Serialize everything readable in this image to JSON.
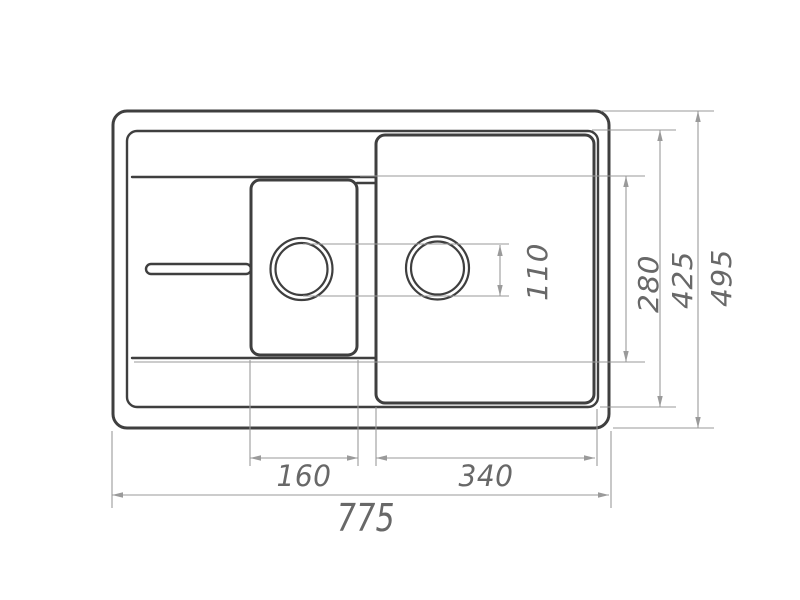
{
  "colors": {
    "background": "#ffffff",
    "outline": "#3f3f3f",
    "dimension_line": "#9a9a9a",
    "dimension_text": "#686868"
  },
  "dimensions": {
    "overall_width": "775",
    "overall_depth": "495",
    "inner_rim_depth": "425",
    "bowl_depth": "280",
    "drain_hole_diameter": "110",
    "left_bowl_width": "160",
    "right_bowl_width": "340"
  }
}
